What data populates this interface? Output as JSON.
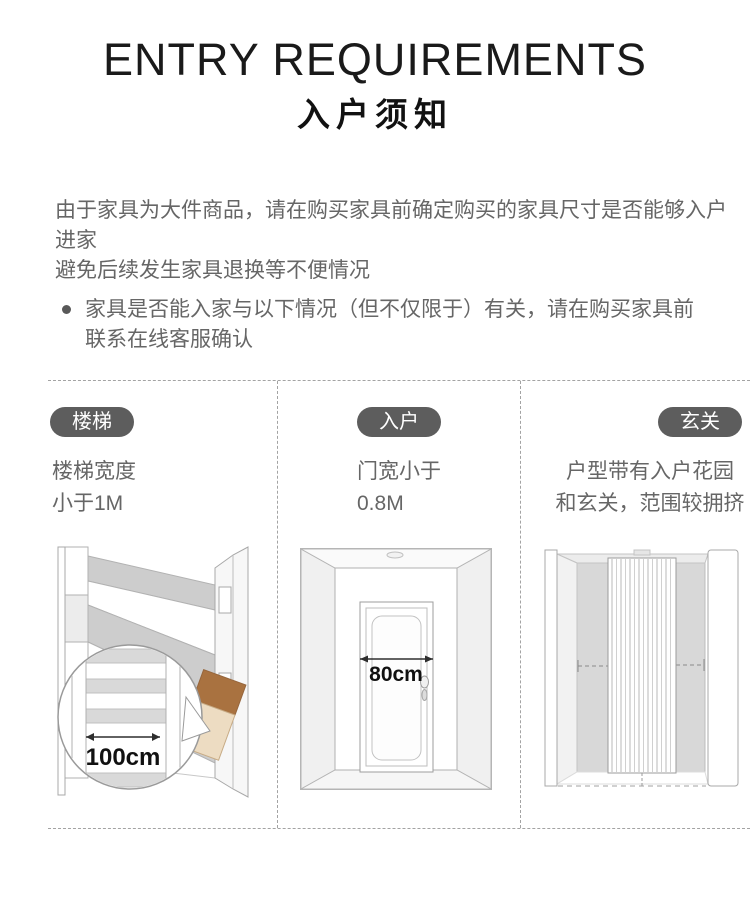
{
  "header": {
    "title_en": "ENTRY REQUIREMENTS",
    "title_zh": "入户须知"
  },
  "intro": {
    "lines": [
      "由于家具为大件商品，请在购买家具前确定购买的家具尺寸是否能够入户进家",
      "避免后续发生家具退换等不便情况"
    ]
  },
  "notice": {
    "lines": [
      "家具是否能入家与以下情况（但不仅限于）有关，请在购买家具前",
      "联系在线客服确认"
    ]
  },
  "columns": [
    {
      "badge": "楼梯",
      "desc_lines": [
        "楼梯宽度",
        "小于1M"
      ],
      "illustration": "staircase-with-width-callout",
      "measurement_label": "100cm"
    },
    {
      "badge": "入户",
      "desc_lines": [
        "门宽小于",
        "0.8M"
      ],
      "illustration": "entry-door",
      "measurement_label": "80cm"
    },
    {
      "badge": "玄关",
      "desc_lines": [
        "户型带有入户花园",
        "和玄关，范围较拥挤"
      ],
      "illustration": "hallway-with-curtain"
    }
  ],
  "colors": {
    "badge_bg": "#5d5d5d",
    "badge_text": "#ffffff",
    "title_text": "#1a1a1a",
    "body_text": "#666666",
    "divider": "#a3a3a3",
    "wall_gray": "#d8d8d8",
    "stair_gray": "#cdcdcd",
    "box_brown": "#a97240",
    "box_beige": "#eddcc2"
  }
}
